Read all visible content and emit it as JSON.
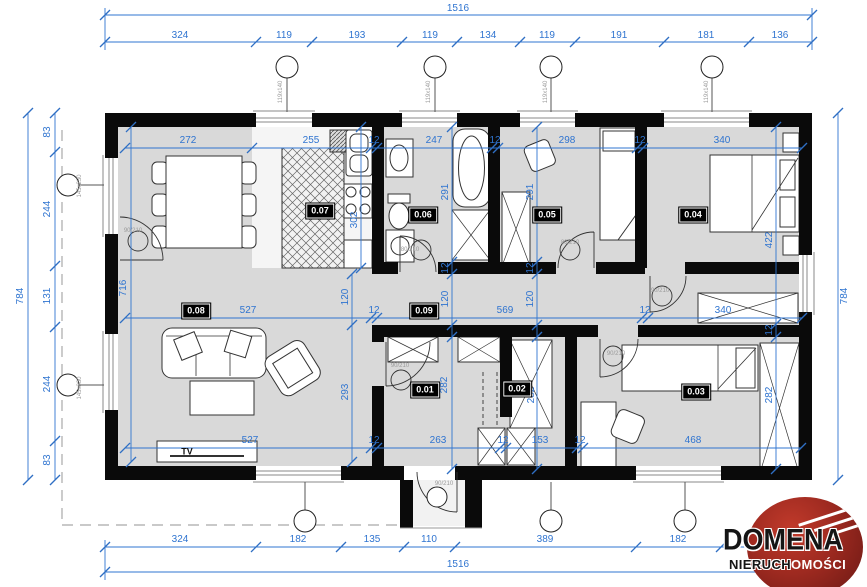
{
  "meta": {
    "drawing_type": "floor plan",
    "colors": {
      "dimension_blue": "#2f74d0",
      "wall_black": "#0a0a0a",
      "floor_gray": "#d9d9d9",
      "logo_red": "#9e2a20"
    }
  },
  "logo": {
    "name": "DOMENA",
    "sub_black": "NIERUCH",
    "sub_white": "OMOŚCI"
  },
  "rooms": [
    {
      "id": "0.01",
      "x": 425,
      "y": 390
    },
    {
      "id": "0.02",
      "x": 517,
      "y": 389
    },
    {
      "id": "0.03",
      "x": 696,
      "y": 392
    },
    {
      "id": "0.04",
      "x": 693,
      "y": 215
    },
    {
      "id": "0.05",
      "x": 547,
      "y": 215
    },
    {
      "id": "0.06",
      "x": 423,
      "y": 215
    },
    {
      "id": "0.07",
      "x": 320,
      "y": 211
    },
    {
      "id": "0.08",
      "x": 196,
      "y": 311
    },
    {
      "id": "0.09",
      "x": 424,
      "y": 311
    }
  ],
  "labels": [
    {
      "t": "TV",
      "x": 187,
      "y": 452
    }
  ],
  "dimensions": [
    {
      "t": "1516",
      "x": 458,
      "y": 9
    },
    {
      "t": "324",
      "x": 180,
      "y": 36
    },
    {
      "t": "119",
      "x": 284,
      "y": 36
    },
    {
      "t": "193",
      "x": 357,
      "y": 36
    },
    {
      "t": "119",
      "x": 430,
      "y": 36
    },
    {
      "t": "134",
      "x": 488,
      "y": 36
    },
    {
      "t": "119",
      "x": 547,
      "y": 36
    },
    {
      "t": "191",
      "x": 619,
      "y": 36
    },
    {
      "t": "181",
      "x": 706,
      "y": 36
    },
    {
      "t": "136",
      "x": 780,
      "y": 36
    },
    {
      "t": "272",
      "x": 188,
      "y": 141
    },
    {
      "t": "255",
      "x": 311,
      "y": 141
    },
    {
      "t": "12",
      "x": 374,
      "y": 141
    },
    {
      "t": "247",
      "x": 434,
      "y": 141
    },
    {
      "t": "12",
      "x": 495,
      "y": 141
    },
    {
      "t": "298",
      "x": 567,
      "y": 141
    },
    {
      "t": "12",
      "x": 640,
      "y": 141
    },
    {
      "t": "340",
      "x": 722,
      "y": 141
    },
    {
      "t": "527",
      "x": 248,
      "y": 311
    },
    {
      "t": "12",
      "x": 374,
      "y": 311
    },
    {
      "t": "569",
      "x": 505,
      "y": 311
    },
    {
      "t": "12",
      "x": 645,
      "y": 311
    },
    {
      "t": "340",
      "x": 723,
      "y": 311
    },
    {
      "t": "527",
      "x": 250,
      "y": 441
    },
    {
      "t": "12",
      "x": 374,
      "y": 441
    },
    {
      "t": "263",
      "x": 438,
      "y": 441
    },
    {
      "t": "12",
      "x": 503,
      "y": 441
    },
    {
      "t": "153",
      "x": 540,
      "y": 441
    },
    {
      "t": "12",
      "x": 580,
      "y": 441
    },
    {
      "t": "468",
      "x": 693,
      "y": 441
    },
    {
      "t": "324",
      "x": 180,
      "y": 540
    },
    {
      "t": "182",
      "x": 298,
      "y": 540
    },
    {
      "t": "135",
      "x": 372,
      "y": 540
    },
    {
      "t": "110",
      "x": 429,
      "y": 540
    },
    {
      "t": "389",
      "x": 545,
      "y": 540
    },
    {
      "t": "182",
      "x": 678,
      "y": 540
    },
    {
      "t": "1516",
      "x": 458,
      "y": 565
    },
    {
      "t": "784",
      "x": 21,
      "y": 296,
      "v": 1
    },
    {
      "t": "83",
      "x": 48,
      "y": 132,
      "v": 1
    },
    {
      "t": "244",
      "x": 48,
      "y": 209,
      "v": 1
    },
    {
      "t": "131",
      "x": 48,
      "y": 296,
      "v": 1
    },
    {
      "t": "244",
      "x": 48,
      "y": 384,
      "v": 1
    },
    {
      "t": "83",
      "x": 48,
      "y": 460,
      "v": 1
    },
    {
      "t": "784",
      "x": 845,
      "y": 296,
      "v": 1
    },
    {
      "t": "716",
      "x": 124,
      "y": 288,
      "v": 1
    },
    {
      "t": "302",
      "x": 355,
      "y": 220,
      "v": 1
    },
    {
      "t": "291",
      "x": 446,
      "y": 192,
      "v": 1
    },
    {
      "t": "12",
      "x": 446,
      "y": 268,
      "v": 1
    },
    {
      "t": "120",
      "x": 446,
      "y": 299,
      "v": 1
    },
    {
      "t": "282",
      "x": 445,
      "y": 385,
      "v": 1
    },
    {
      "t": "291",
      "x": 531,
      "y": 192,
      "v": 1
    },
    {
      "t": "12",
      "x": 531,
      "y": 268,
      "v": 1
    },
    {
      "t": "120",
      "x": 531,
      "y": 299,
      "v": 1
    },
    {
      "t": "282",
      "x": 532,
      "y": 395,
      "v": 1
    },
    {
      "t": "120",
      "x": 346,
      "y": 297,
      "v": 1
    },
    {
      "t": "293",
      "x": 346,
      "y": 392,
      "v": 1
    },
    {
      "t": "422",
      "x": 770,
      "y": 240,
      "v": 1
    },
    {
      "t": "12",
      "x": 770,
      "y": 330,
      "v": 1
    },
    {
      "t": "282",
      "x": 770,
      "y": 395,
      "v": 1
    }
  ],
  "annotations": [
    {
      "t": "145x230",
      "x": 80,
      "y": 186,
      "v": 1
    },
    {
      "t": "145x230",
      "x": 80,
      "y": 388,
      "v": 1
    },
    {
      "t": "119x140",
      "x": 281,
      "y": 92,
      "v": 1
    },
    {
      "t": "119x140",
      "x": 429,
      "y": 92,
      "v": 1
    },
    {
      "t": "119x140",
      "x": 546,
      "y": 92,
      "v": 1
    },
    {
      "t": "119x140",
      "x": 707,
      "y": 92,
      "v": 1
    },
    {
      "t": "90/210",
      "x": 133,
      "y": 231
    },
    {
      "t": "80/210",
      "x": 410,
      "y": 250
    },
    {
      "t": "80/210",
      "x": 570,
      "y": 243
    },
    {
      "t": "90/210",
      "x": 660,
      "y": 291
    },
    {
      "t": "90/210",
      "x": 616,
      "y": 354
    },
    {
      "t": "90/210",
      "x": 400,
      "y": 366
    },
    {
      "t": "90/210",
      "x": 444,
      "y": 484
    }
  ]
}
